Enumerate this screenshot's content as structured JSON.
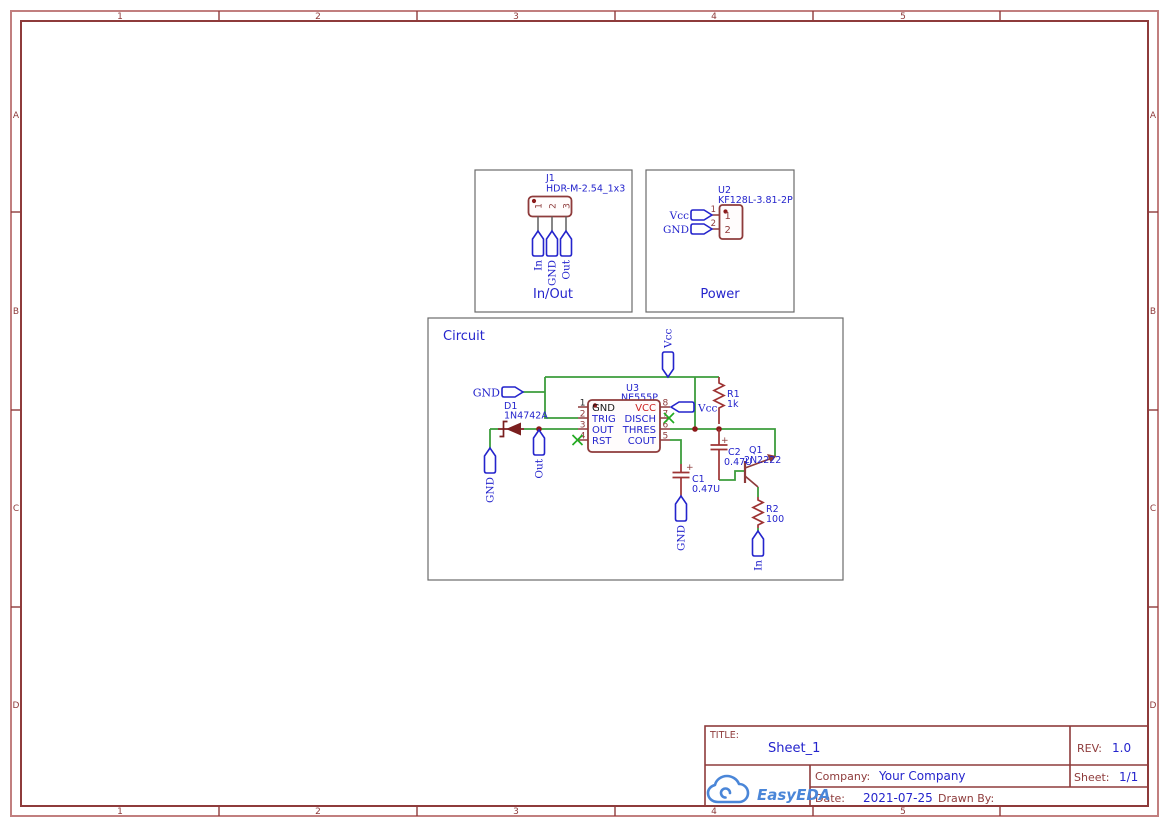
{
  "ruler": {
    "cols": [
      "1",
      "2",
      "3",
      "4",
      "5"
    ],
    "rows": [
      "A",
      "B",
      "C",
      "D"
    ]
  },
  "boxes": {
    "inout_label": "In/Out",
    "power_label": "Power",
    "circuit_label": "Circuit"
  },
  "nets": {
    "gnd": "GND",
    "vcc": "Vcc",
    "out": "Out",
    "in": "In"
  },
  "components": {
    "j1": {
      "ref": "J1",
      "footprint": "HDR-M-2.54_1x3",
      "pins": [
        "1",
        "2",
        "3"
      ]
    },
    "u2": {
      "ref": "U2",
      "footprint": "KF128L-3.81-2P",
      "pin_numbers": [
        "1",
        "2"
      ]
    },
    "u3": {
      "ref": "U3",
      "part": "NE555P",
      "left_pins": [
        {
          "num": "1",
          "name": "GND"
        },
        {
          "num": "2",
          "name": "TRIG"
        },
        {
          "num": "3",
          "name": "OUT"
        },
        {
          "num": "4",
          "name": "RST"
        }
      ],
      "right_pins": [
        {
          "num": "8",
          "name": "VCC"
        },
        {
          "num": "7",
          "name": "DISCH"
        },
        {
          "num": "6",
          "name": "THRES"
        },
        {
          "num": "5",
          "name": "COUT"
        }
      ]
    },
    "d1": {
      "ref": "D1",
      "value": "1N4742A"
    },
    "r1": {
      "ref": "R1",
      "value": "1k"
    },
    "r2": {
      "ref": "R2",
      "value": "100"
    },
    "c1": {
      "ref": "C1",
      "value": "0.47U"
    },
    "c2": {
      "ref": "C2",
      "value": "0.47U"
    },
    "q1": {
      "ref": "Q1",
      "value": "2N2222"
    }
  },
  "title_block": {
    "title_label": "TITLE:",
    "title": "Sheet_1",
    "rev_label": "REV:",
    "rev": "1.0",
    "company_label": "Company:",
    "company": "Your Company",
    "sheet_label": "Sheet:",
    "sheet": "1/1",
    "date_label": "Date:",
    "date": "2021-07-25",
    "drawn_by_label": "Drawn By:",
    "logo_text": "EasyEDA"
  },
  "colors": {
    "frame_outer": "#c17f7f",
    "frame_inner": "#8e3b3b",
    "wire_green": "#3c9d3c",
    "symbol_maroon": "#8e3b3b",
    "annotation_blue": "#2424cc",
    "logo_blue": "#4a86d8",
    "pin_vcc_red": "#cc2222",
    "no_connect_green": "#22aa22"
  }
}
